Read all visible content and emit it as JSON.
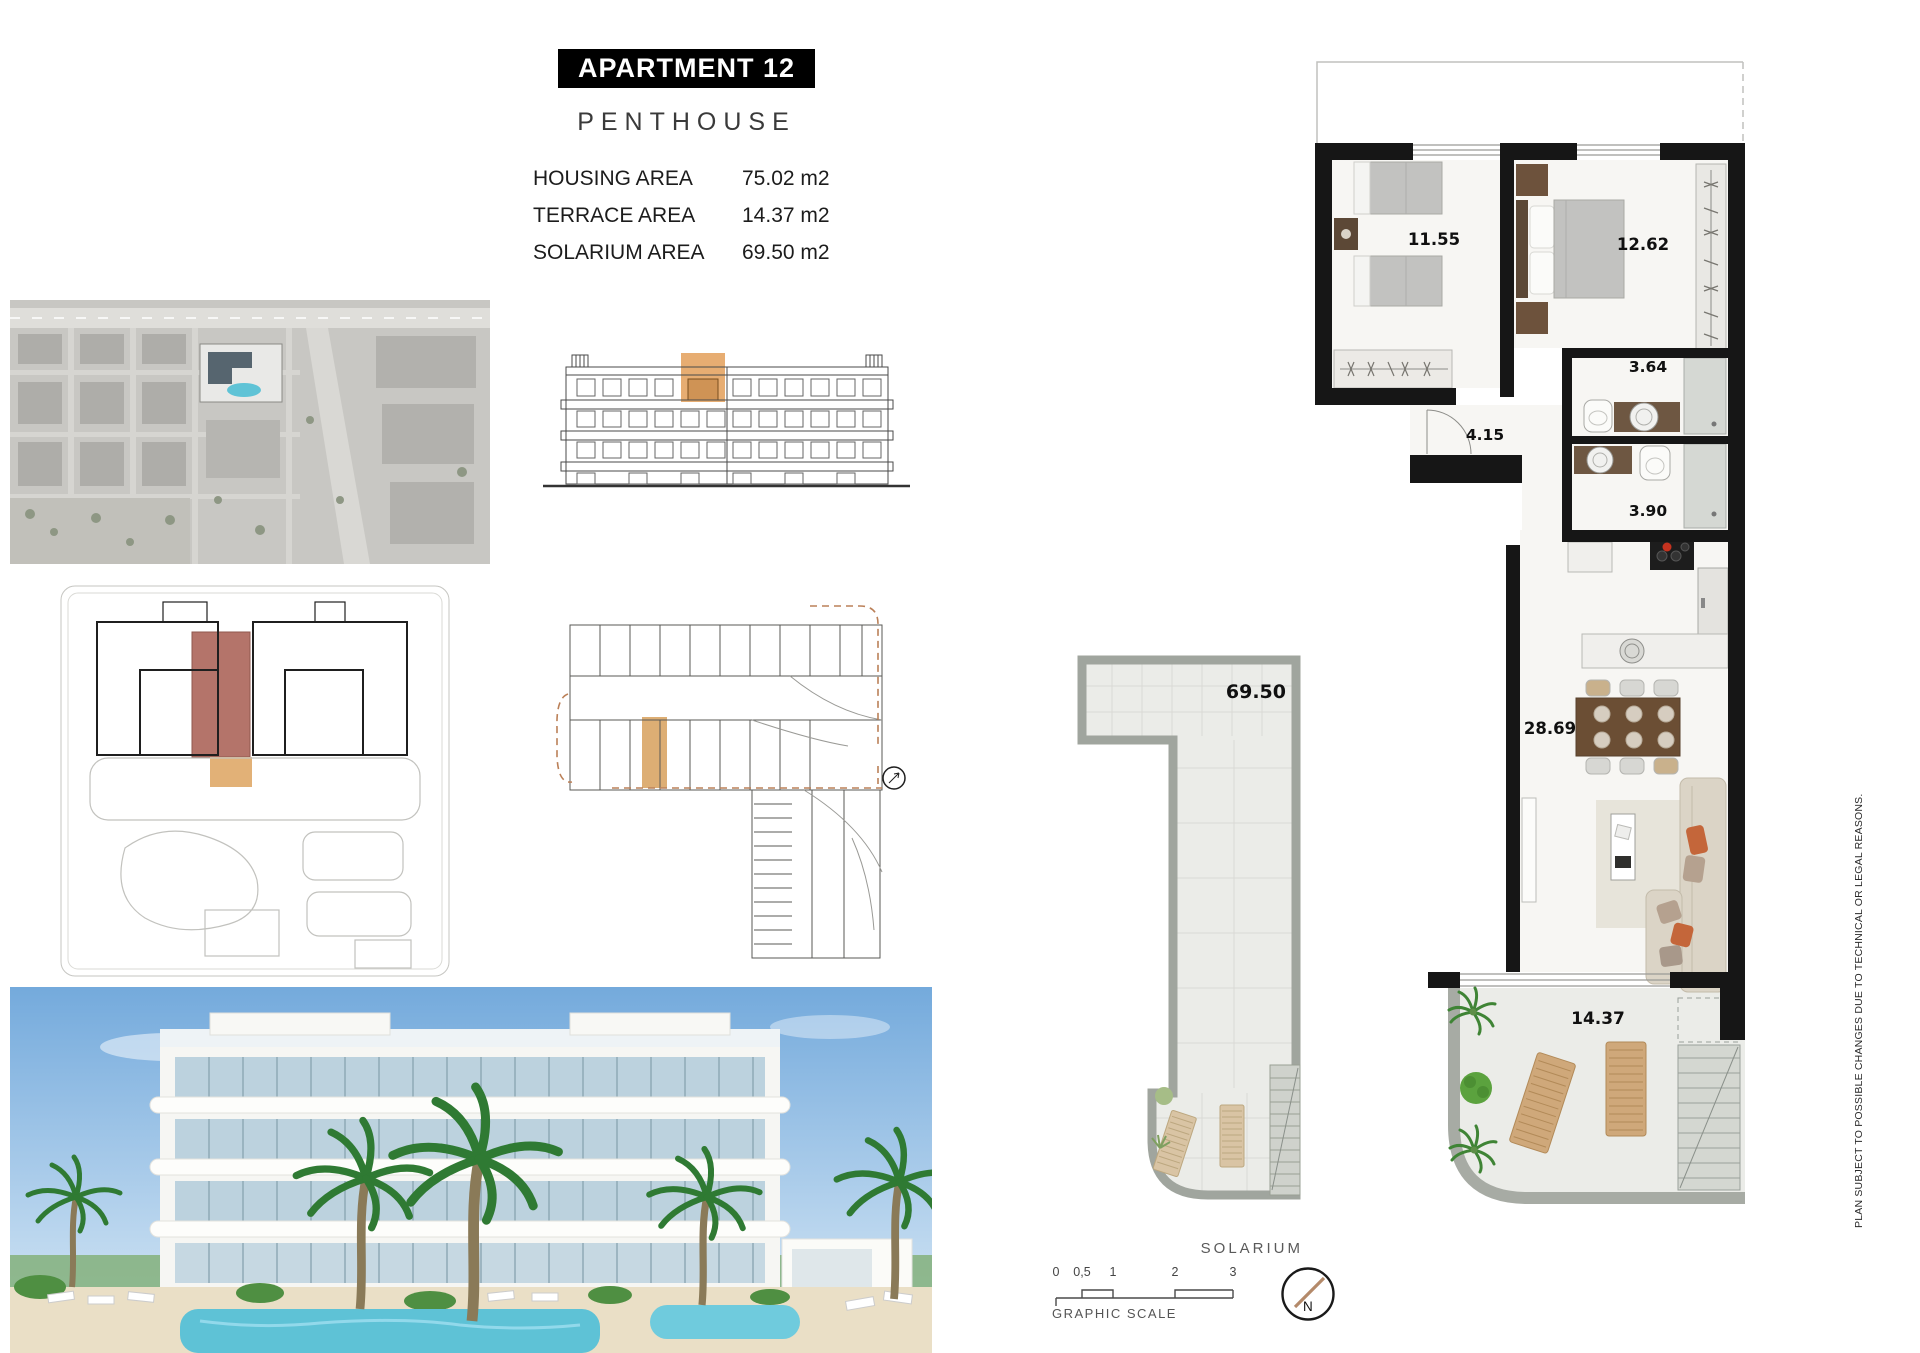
{
  "header": {
    "title": "APARTMENT 12",
    "subtitle": "PENTHOUSE"
  },
  "areas": {
    "rows": [
      {
        "label": "HOUSING AREA",
        "value": "75.02 m2"
      },
      {
        "label": "TERRACE AREA",
        "value": "14.37 m2"
      },
      {
        "label": "SOLARIUM AREA",
        "value": "69.50 m2"
      }
    ]
  },
  "floor_plan": {
    "rooms": [
      {
        "id": "bedroom-1",
        "area": "11.55"
      },
      {
        "id": "bedroom-2",
        "area": "12.62"
      },
      {
        "id": "bathroom-1",
        "area": "3.64"
      },
      {
        "id": "hallway",
        "area": "4.15"
      },
      {
        "id": "bathroom-2",
        "area": "3.90"
      },
      {
        "id": "living-dining-kitchen",
        "area": "28.69"
      },
      {
        "id": "terrace",
        "area": "14.37"
      }
    ]
  },
  "solarium": {
    "area": "69.50",
    "caption": "SOLARIUM"
  },
  "graphic_scale": {
    "ticks": [
      "0",
      "0,5",
      "1",
      "2",
      "3"
    ],
    "caption": "GRAPHIC SCALE"
  },
  "compass": {
    "north": "N"
  },
  "disclaimer": "PLAN SUBJECT TO POSSIBLE CHANGES DUE TO TECHNICAL OR LEGAL REASONS.",
  "colors": {
    "unit_highlight": "#ddae74",
    "unit_highlight_dark": "#b4746a",
    "wall": "#161616",
    "wood_dark": "#5c4836",
    "lounger_wood": "#cfa87a",
    "pool": "#5ec2d6",
    "burner_red": "#c4321f"
  }
}
